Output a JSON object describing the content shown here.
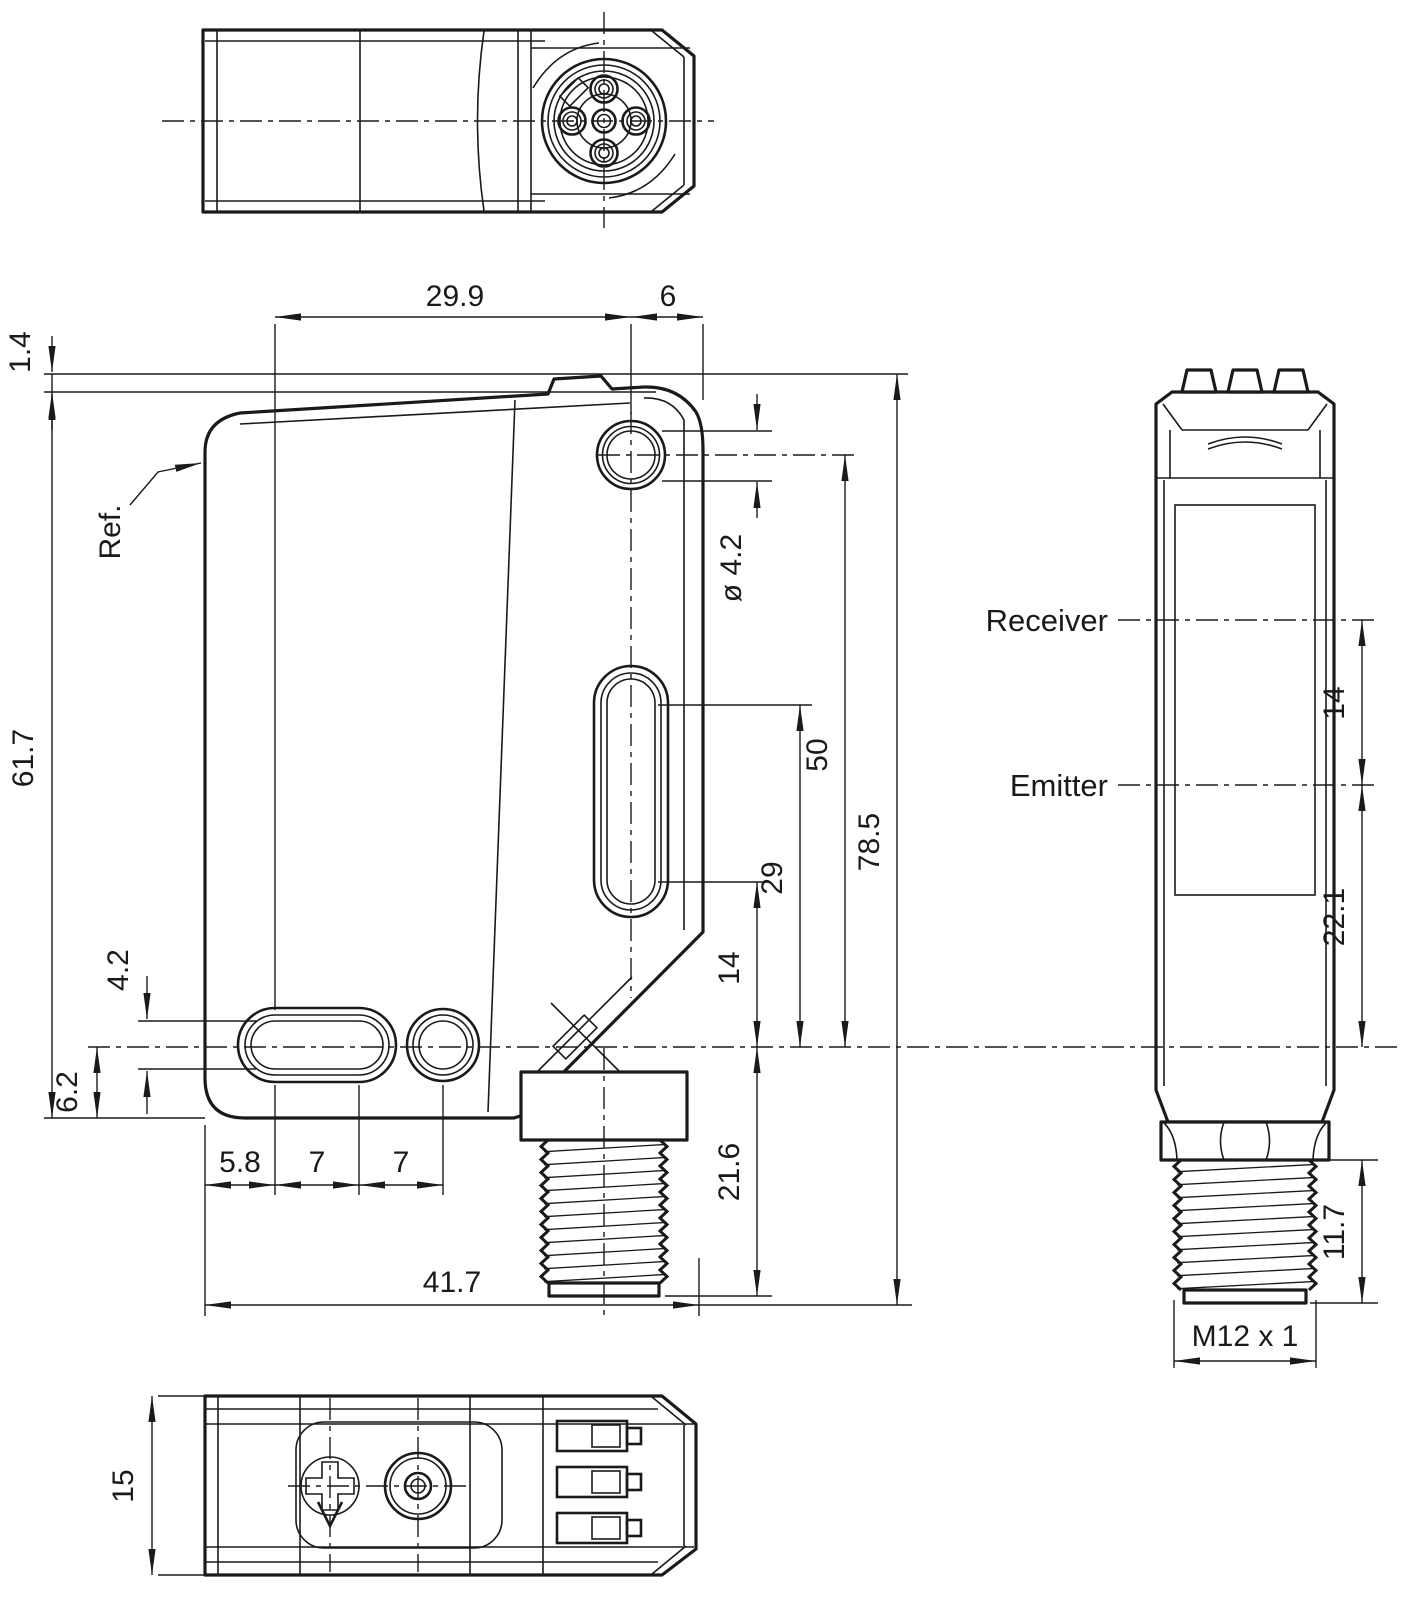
{
  "labels": {
    "ref": "Ref.",
    "receiver": "Receiver",
    "emitter": "Emitter"
  },
  "dimensions": {
    "front": {
      "width_to_hole_axis": "29.9",
      "hole_axis_to_edge": "6",
      "tab_offset": "1.4",
      "body_height": "61.7",
      "slot_height": "4.2",
      "axis_to_bottom_face": "6.2",
      "edge_to_slot_start": "5.8",
      "slot_pitch_a": "7",
      "slot_pitch_b": "7",
      "overall_width": "41.7",
      "mounting_hole_diameter": "ø 4.2",
      "hole_axis_to_optical_axis": "50",
      "slot_top_to_optical_axis": "29",
      "slot_bottom_to_optical_axis": "14",
      "overall_height": "78.5",
      "optical_axis_to_connector_end": "21.6"
    },
    "side": {
      "receiver_to_emitter": "14",
      "emitter_to_mounting_axis": "22.1",
      "thread_length": "11.7",
      "connector_thread": "M12 x 1"
    },
    "bottom": {
      "housing_width": "15"
    }
  }
}
